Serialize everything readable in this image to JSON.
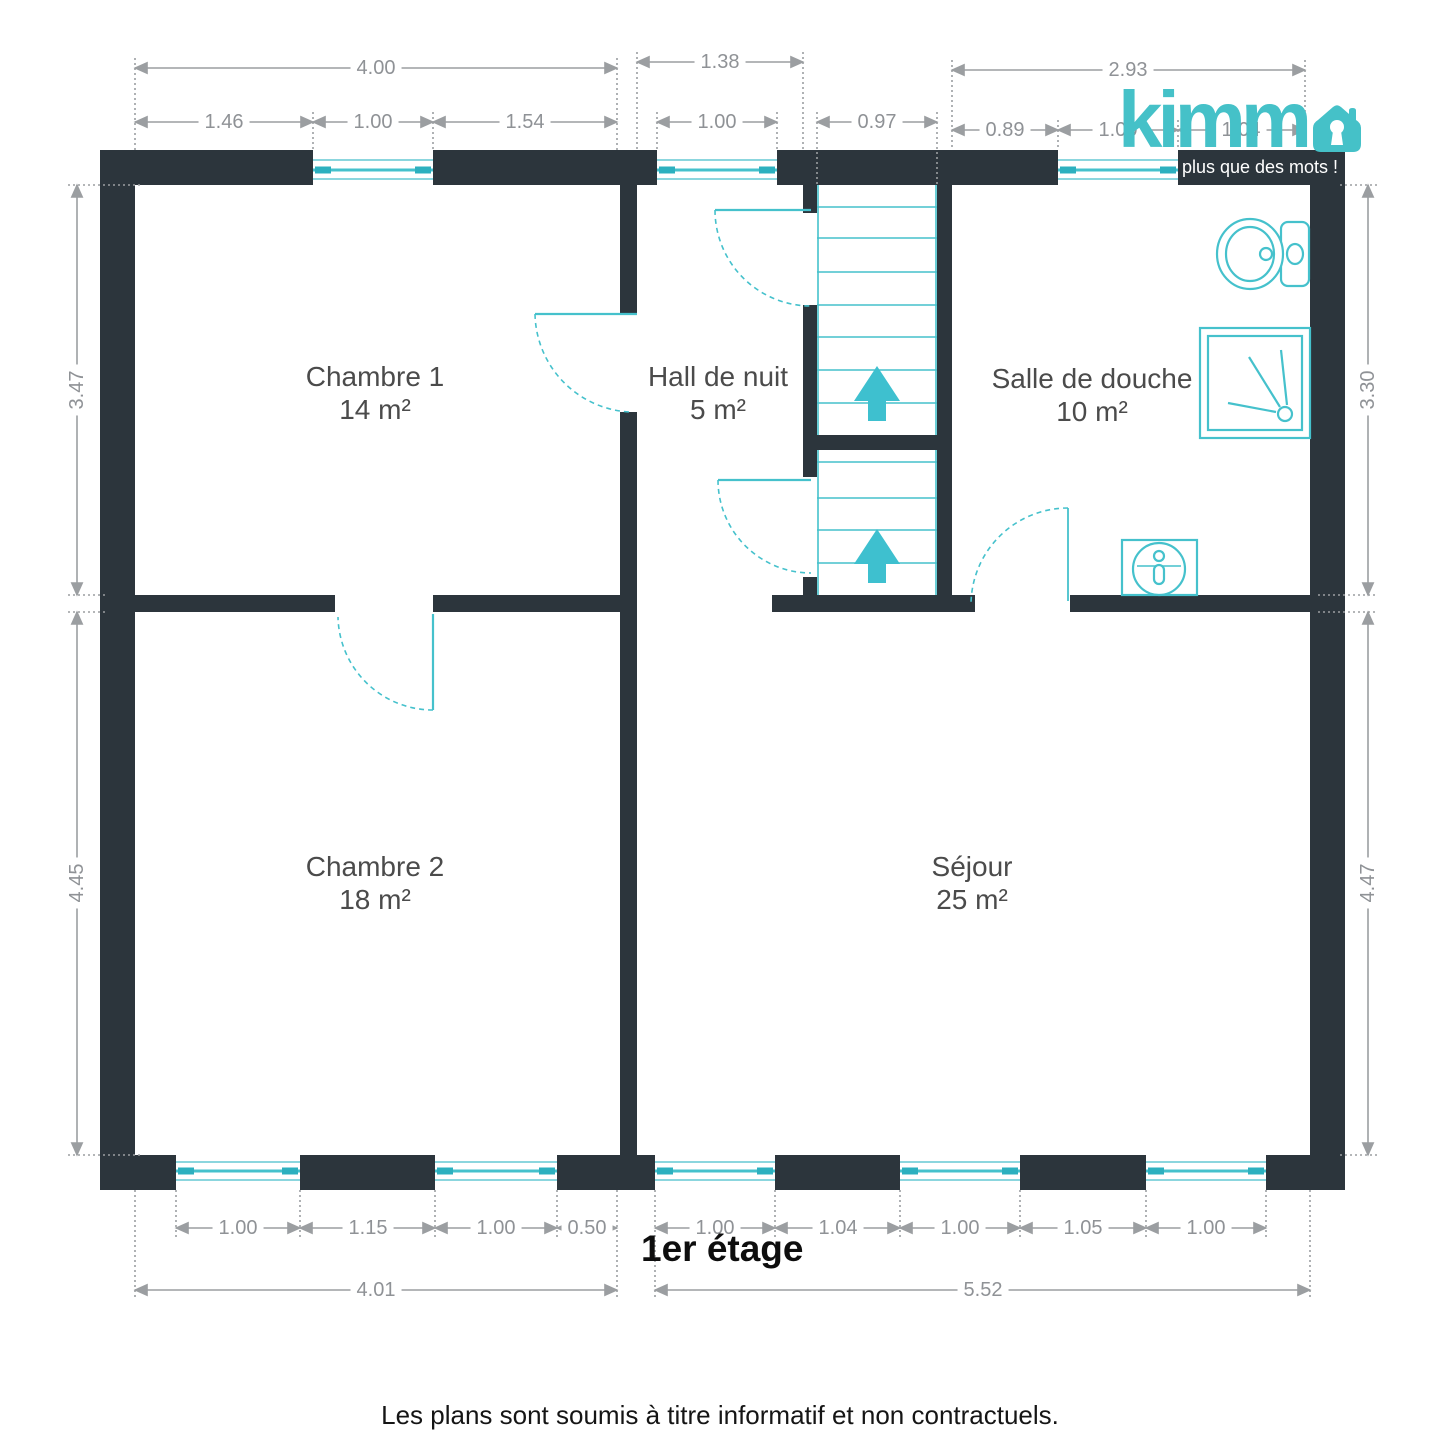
{
  "brand": {
    "name": "kimmo",
    "wordmark_text": "kimm",
    "tagline": "plus que des mots !"
  },
  "floor_title": "1er étage",
  "disclaimer": "Les plans sont soumis à titre informatif et non contractuels.",
  "rooms": [
    {
      "name": "Chambre 1",
      "area": "14 m²"
    },
    {
      "name": "Hall de nuit",
      "area": "5 m²"
    },
    {
      "name": "Salle de douche",
      "area": "10 m²"
    },
    {
      "name": "Chambre 2",
      "area": "18 m²"
    },
    {
      "name": "Séjour",
      "area": "25 m²"
    }
  ],
  "dimensions": {
    "top_left_total": "4.00",
    "top_left_a": "1.46",
    "top_left_b": "1.00",
    "top_left_c": "1.54",
    "top_hall_total": "1.38",
    "top_hall_window": "1.00",
    "top_stairs": "0.97",
    "top_right_total": "2.93",
    "top_right_a": "0.89",
    "top_right_b": "1.00",
    "top_right_c": "1.04",
    "side_left_upper": "3.47",
    "side_left_lower": "4.45",
    "side_right_upper": "3.30",
    "side_right_lower": "4.47",
    "bottom_left_a": "1.00",
    "bottom_left_b": "1.15",
    "bottom_left_c": "1.00",
    "bottom_left_d": "0.50",
    "bottom_left_total": "4.01",
    "bottom_right_a": "1.00",
    "bottom_right_b": "1.04",
    "bottom_right_c": "1.00",
    "bottom_right_d": "1.05",
    "bottom_right_e": "1.00",
    "bottom_right_total": "5.52"
  },
  "colors": {
    "wall": "#2c353c",
    "accent_teal": "#45c1cc",
    "window_light_teal": "#8bd6de",
    "dimension_gray": "#9b9ea1",
    "room_label": "#4b4b4b"
  }
}
